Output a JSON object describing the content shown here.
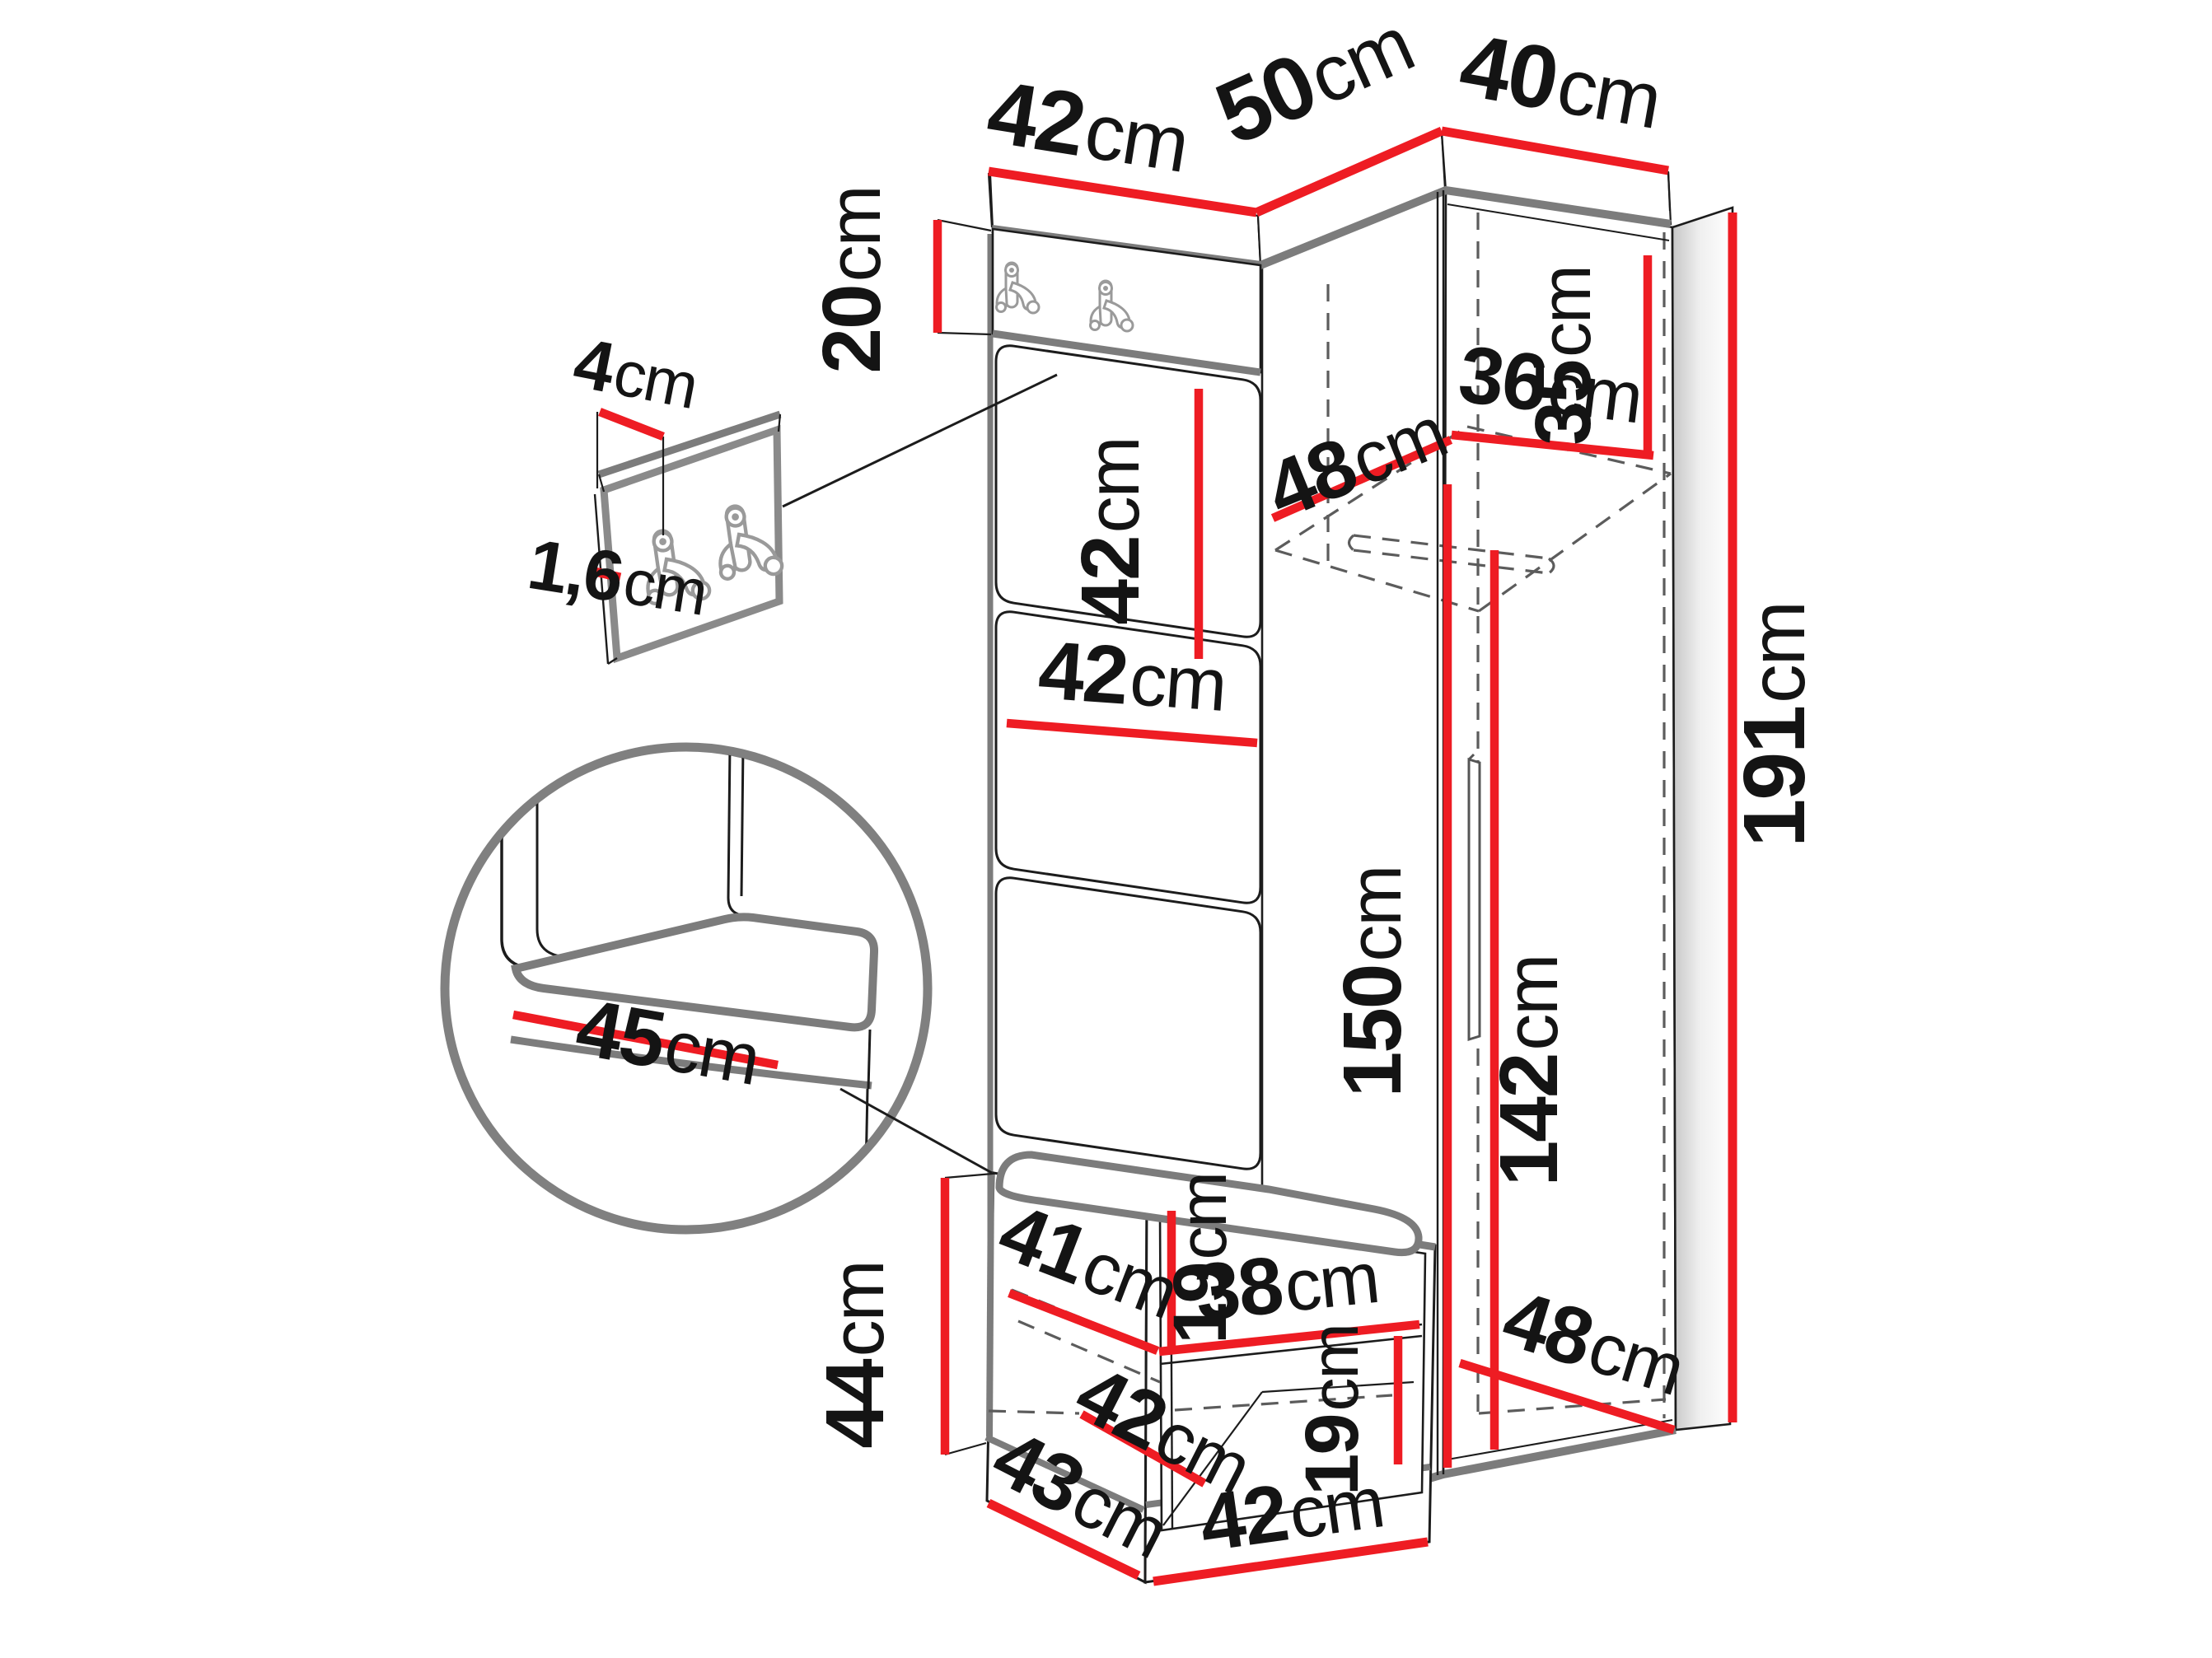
{
  "diagram": {
    "type": "furniture-dimension-drawing",
    "subject": "corner hallway wardrobe set with hook panel, upholstered wall panels, bench and tall corner wardrobe",
    "unit": "cm",
    "dimension_color": "#ee1c23",
    "outline_color": "#7c7c7c"
  },
  "labels": {
    "top_42": {
      "v": "42",
      "u": "cm"
    },
    "top_50": {
      "v": "50",
      "u": "cm"
    },
    "top_40": {
      "v": "40",
      "u": "cm"
    },
    "hook_20": {
      "v": "20",
      "u": "cm"
    },
    "panel_42_v": {
      "v": "42",
      "u": "cm"
    },
    "panel_42_h": {
      "v": "42",
      "u": "cm"
    },
    "shelf_48": {
      "v": "48",
      "u": "cm"
    },
    "shelf_36": {
      "v": "36",
      "u": "cm"
    },
    "top_35": {
      "v": "35",
      "u": "cm"
    },
    "height_191": {
      "v": "191",
      "u": "cm"
    },
    "interior_150": {
      "v": "150",
      "u": "cm"
    },
    "rail_142": {
      "v": "142",
      "u": "cm"
    },
    "bench_44": {
      "v": "44",
      "u": "cm"
    },
    "bench_19_top": {
      "v": "19",
      "u": "cm"
    },
    "bench_41": {
      "v": "41",
      "u": "cm"
    },
    "bench_38": {
      "v": "38",
      "u": "cm"
    },
    "bench_19_bot": {
      "v": "19",
      "u": "cm"
    },
    "bench_42_in": {
      "v": "42",
      "u": "cm"
    },
    "bench_43": {
      "v": "43",
      "u": "cm"
    },
    "bench_42_fr": {
      "v": "42",
      "u": "cm"
    },
    "bottom_48": {
      "v": "48",
      "u": "cm"
    },
    "detail_4": {
      "v": "4",
      "u": "cm"
    },
    "detail_1_6": {
      "v": "1,6",
      "u": "cm"
    },
    "cushion_45": {
      "v": "45",
      "u": "cm"
    }
  }
}
